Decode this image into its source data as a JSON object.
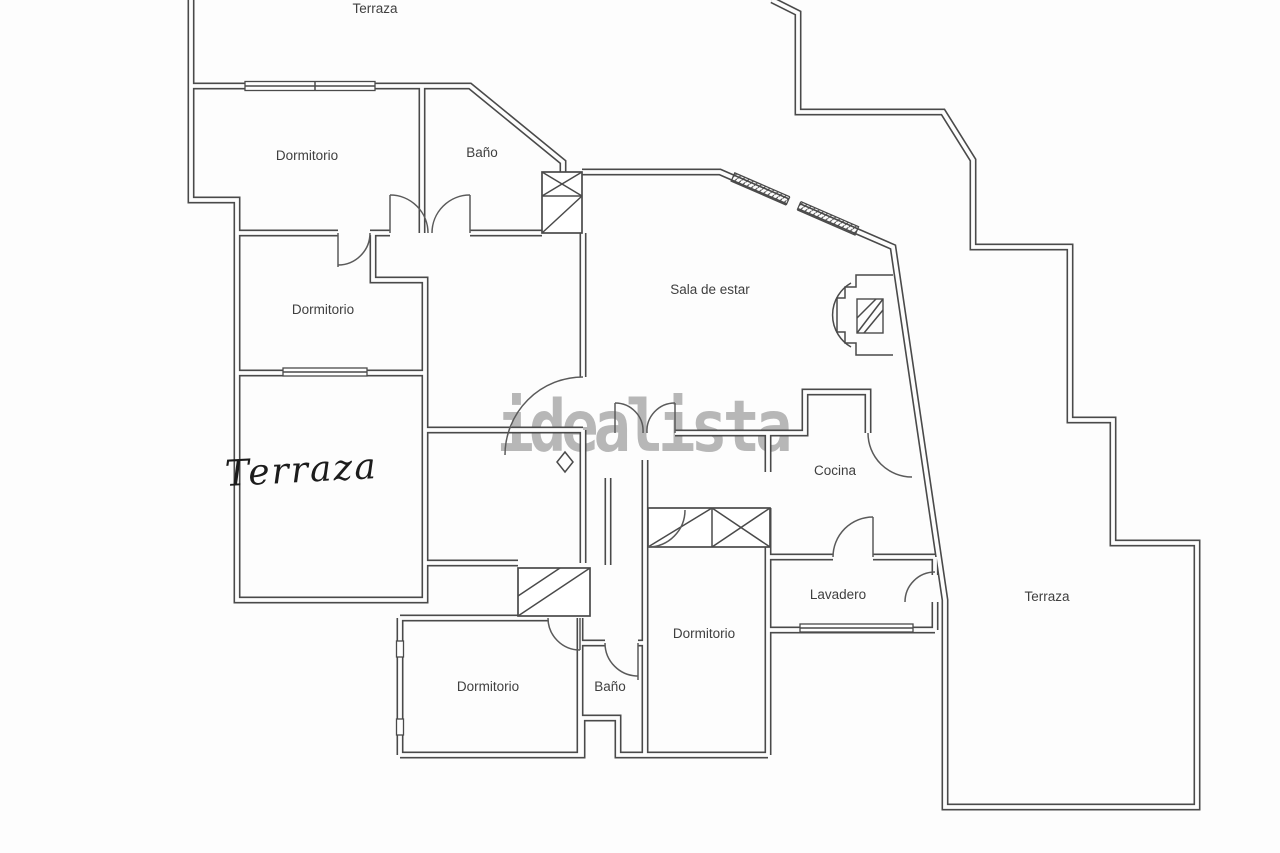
{
  "document": {
    "type": "floor-plan",
    "watermark": "idealista"
  },
  "colors": {
    "wall": "#4a4a4a",
    "background": "#fdfdfd",
    "label": "#3f3f3f",
    "watermark": "#a8a8a8"
  },
  "labels": {
    "terraza_top": "Terraza",
    "dormitorio_top_left": "Dormitorio",
    "bano_top": "Baño",
    "dormitorio_mid_left": "Dormitorio",
    "terraza_left_handwritten": "Terraza",
    "sala_de_estar": "Sala de estar",
    "cocina": "Cocina",
    "lavadero": "Lavadero",
    "dormitorio_bottom_center": "Dormitorio",
    "dormitorio_bottom_left": "Dormitorio",
    "bano_bottom": "Baño",
    "terraza_right": "Terraza"
  }
}
